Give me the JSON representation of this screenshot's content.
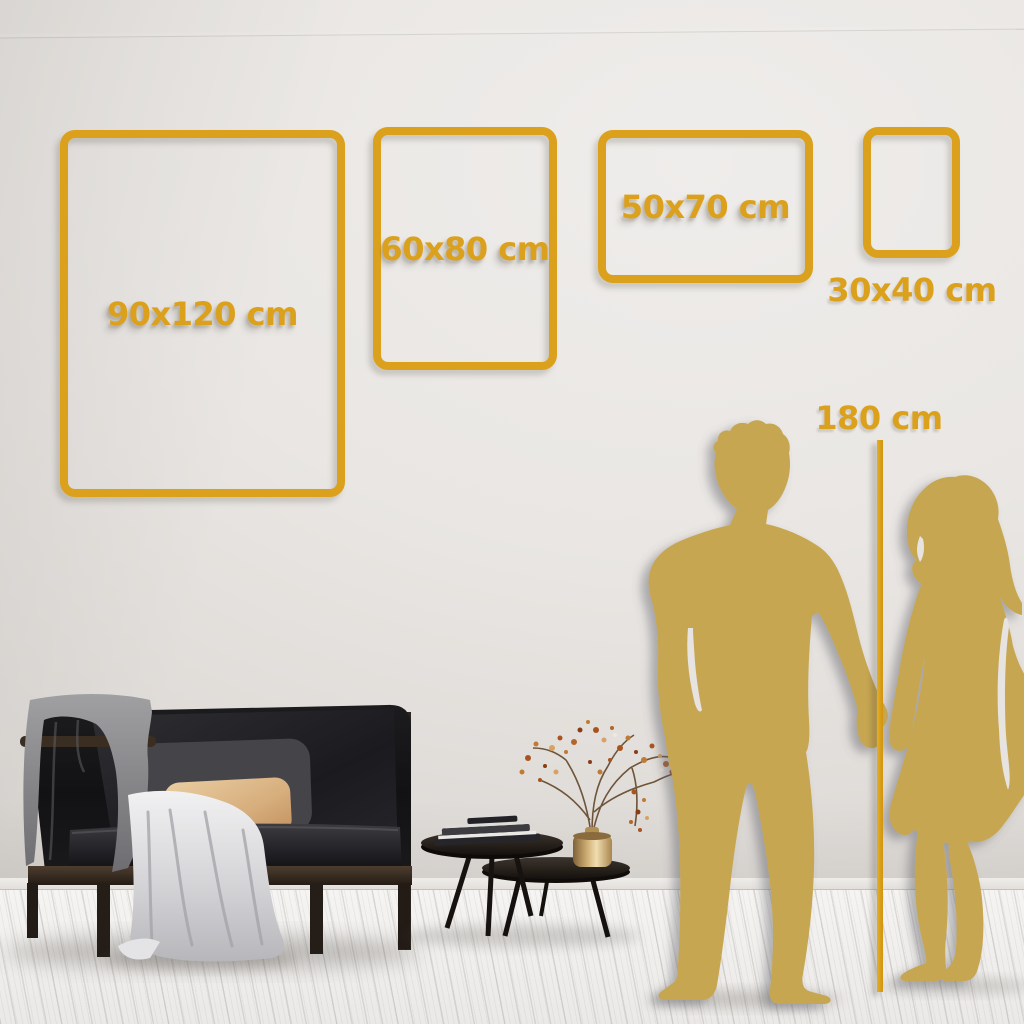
{
  "size_guide": {
    "title": "poster-size-comparison",
    "sizes": [
      {
        "label": "90x120 cm"
      },
      {
        "label": "60x80 cm"
      },
      {
        "label": "50x70 cm"
      },
      {
        "label": "30x40 cm"
      }
    ],
    "height_reference": {
      "label": "180 cm"
    }
  },
  "colors": {
    "accent_gold": "#dca11c",
    "silhouette_gold": "#c7a651",
    "wall_light": "#e9e6e3",
    "wall_dark": "#d9d5d1",
    "floor_light": "#f5f4f2"
  },
  "scene_objects": [
    "wall",
    "wood-plank-floor",
    "black-sofa",
    "gray-blanket",
    "white-throw",
    "dark-cushion",
    "beige-cushion",
    "nesting-coffee-tables",
    "stacked-books",
    "brass-vase",
    "dried-branch-plant",
    "man-silhouette",
    "woman-silhouette",
    "height-reference-line"
  ]
}
